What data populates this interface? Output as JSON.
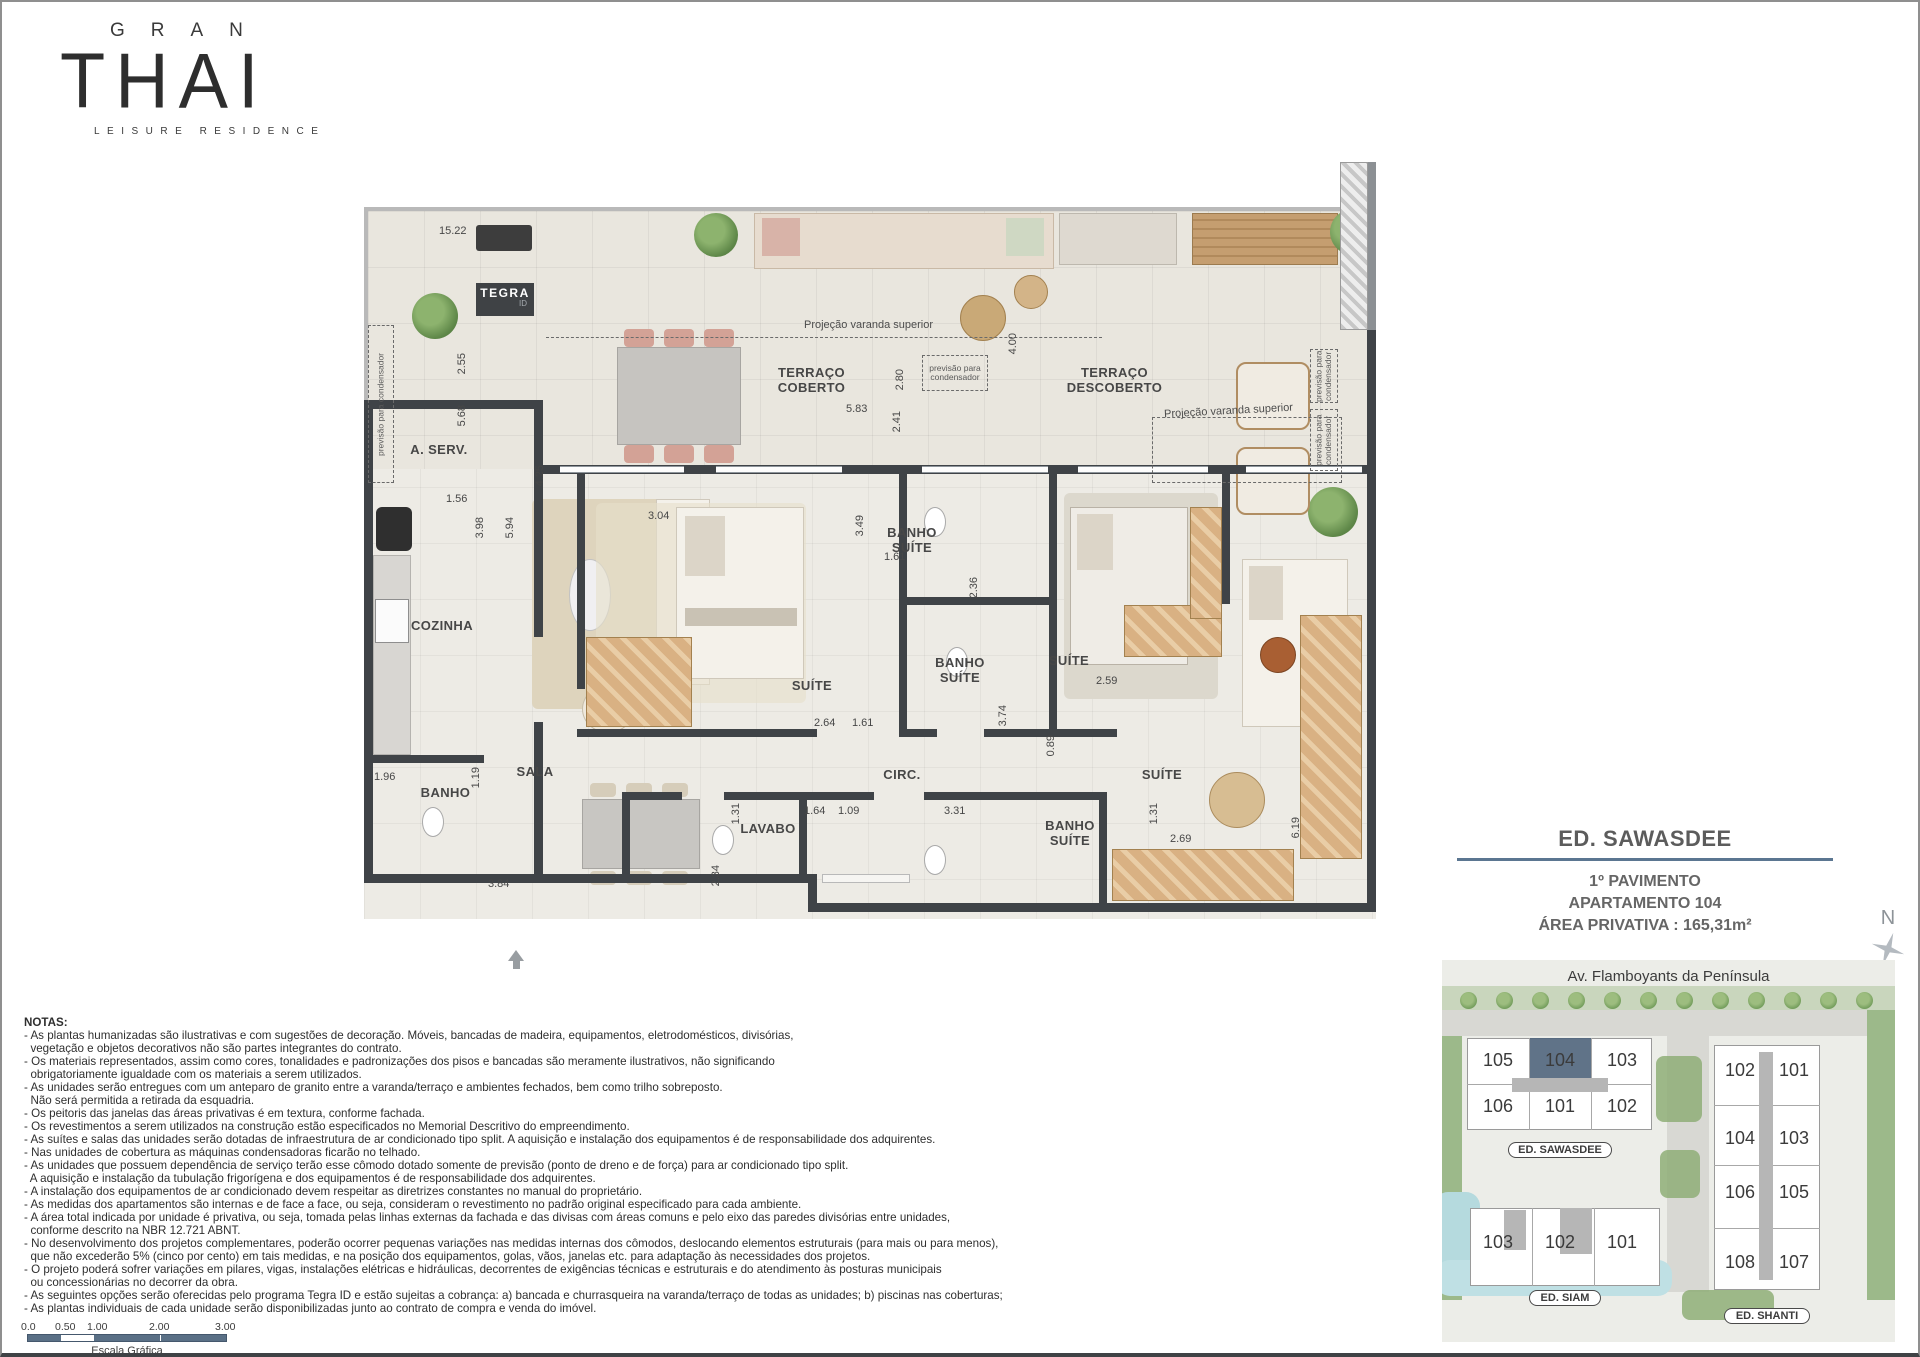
{
  "logo": {
    "top": "GRAN",
    "main": "THAI",
    "sub": "LEISURE RESIDENCE"
  },
  "plan": {
    "badge": {
      "brand": "TEGRA",
      "suffix": "ID"
    },
    "rooms": {
      "a_serv": "A. SERV.",
      "cozinha": "COZINHA",
      "sala": "SALA",
      "banho": "BANHO",
      "terraco_coberto": "TERRAÇO COBERTO",
      "terraco_descoberto": "TERRAÇO DESCOBERTO",
      "banho_suite": "BANHO SUÍTE",
      "suite": "SUÍTE",
      "circ": "CIRC.",
      "lavabo": "LAVABO"
    },
    "annotations": {
      "projecao": "Projeção varanda superior",
      "previsao": "previsão para condensador"
    },
    "dims": [
      "15.22",
      "2.55",
      "5.68",
      "1.56",
      "3.98",
      "5.94",
      "4.25",
      "3.04",
      "5.83",
      "2.80",
      "2.41",
      "4.00",
      "3.49",
      "1.61",
      "2.36",
      "2.64",
      "1.61",
      "2.59",
      "3.74",
      "0.89",
      "1.96",
      "1.19",
      "3.84",
      "2.34",
      "1.31",
      "1.64",
      "1.09",
      "3.31",
      "1.31",
      "2.69",
      "6.19"
    ]
  },
  "info_panel": {
    "building": "ED. SAWASDEE",
    "floor": "1º PAVIMENTO",
    "unit": "APARTAMENTO 104",
    "area": "ÁREA PRIVATIVA : 165,31m²"
  },
  "compass": {
    "n": "N"
  },
  "site_map": {
    "street": "Av. Flamboyants da Península",
    "highlight_color": "#53677e",
    "sawasdee": {
      "label": "ED. SAWASDEE",
      "units": [
        "105",
        "104",
        "103",
        "106",
        "101",
        "102"
      ],
      "highlight": "104"
    },
    "shanti": {
      "label": "ED. SHANTI",
      "units": [
        "102",
        "101",
        "104",
        "103",
        "106",
        "105",
        "108",
        "107"
      ]
    },
    "siam": {
      "label": "ED. SIAM",
      "units": [
        "103",
        "102",
        "101"
      ]
    }
  },
  "notes": {
    "title": "NOTAS:",
    "lines": [
      "- As plantas humanizadas são ilustrativas e com sugestões de decoração. Móveis, bancadas de madeira, equipamentos, eletrodomésticos, divisórias,",
      "  vegetação e objetos decorativos não são partes integrantes do contrato.",
      "- Os materiais representados, assim como cores, tonalidades e padronizações dos pisos e bancadas são meramente ilustrativos, não significando",
      "  obrigatoriamente igualdade com os materiais a serem utilizados.",
      "- As unidades serão entregues com um anteparo de granito entre a varanda/terraço e ambientes fechados, bem como trilho sobreposto.",
      "  Não será permitida a retirada da esquadria.",
      "- Os peitoris das janelas das áreas privativas é em textura, conforme fachada.",
      "- Os revestimentos a serem utilizados na construção estão especificados no Memorial Descritivo do empreendimento.",
      "- As suítes e salas das unidades serão dotadas de infraestrutura de ar condicionado tipo split. A aquisição e instalação dos equipamentos é de responsabilidade dos adquirentes.",
      "- Nas unidades de cobertura as máquinas condensadoras ficarão no telhado.",
      "- As unidades que possuem dependência de serviço terão esse cômodo dotado somente de previsão (ponto de dreno e de força) para ar condicionado tipo split.",
      "  A aquisição e instalação da tubulação frigorígena e dos equipamentos é de responsabilidade dos adquirentes.",
      "- A instalação dos equipamentos de ar condicionado devem respeitar as diretrizes constantes no manual do proprietário.",
      "- As medidas dos apartamentos são internas e de face a face, ou seja, consideram o revestimento no padrão original especificado para cada ambiente.",
      "- A área total indicada por unidade é privativa, ou seja, tomada pelas linhas externas da fachada e das divisas com áreas comuns e pelo eixo das paredes divisórias entre unidades,",
      "  conforme descrito na NBR 12.721 ABNT.",
      "- No desenvolvimento dos projetos complementares, poderão ocorrer pequenas variações nas medidas internas dos cômodos, deslocando elementos estruturais (para mais ou para menos),",
      "  que não excederão 5% (cinco por cento) em tais medidas, e na posição dos equipamentos, golas, vãos, janelas etc. para adaptação às necessidades dos projetos.",
      "- O projeto poderá sofrer variações em pilares, vigas, instalações elétricas e hidráulicas, decorrentes de exigências técnicas e estruturais e do atendimento às posturas municipais",
      "  ou concessionárias no decorrer da obra.",
      "- As seguintes opções serão oferecidas pelo programa Tegra ID e estão sujeitas a cobrança: a) bancada e churrasqueira na varanda/terraço de todas as unidades; b) piscinas nas coberturas;",
      "- As plantas individuais de cada unidade serão disponibilizadas junto ao contrato de compra e venda do imóvel."
    ]
  },
  "scale_bar": {
    "ticks": [
      "0.0",
      "0.50",
      "1.00",
      "2.00",
      "3.00"
    ],
    "label": "Escala Gráfica"
  }
}
